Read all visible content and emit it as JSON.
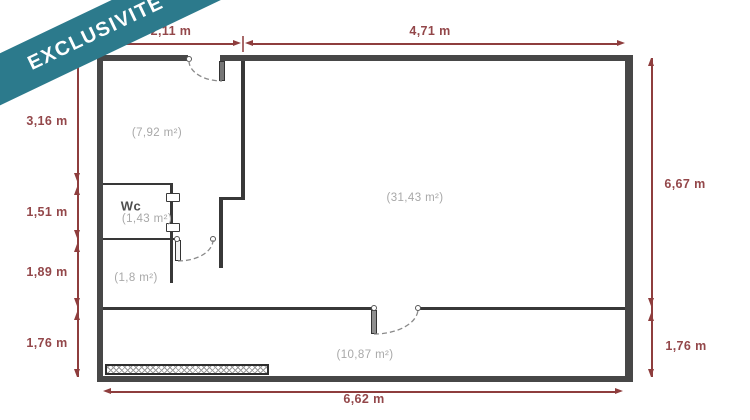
{
  "banner": {
    "label": "EXCLUSIVITÉ"
  },
  "colors": {
    "banner_teal": "#2c7a8c",
    "dimension_red": "#8e3d3d",
    "wall_gray": "#474747",
    "room_label_gray": "#a8a8a8"
  },
  "dimensions": {
    "top": [
      {
        "label": "2,11 m"
      },
      {
        "label": "4,71 m"
      }
    ],
    "left": [
      {
        "label": "3,16 m"
      },
      {
        "label": "1,51 m"
      },
      {
        "label": "1,89 m"
      },
      {
        "label": "1,76 m"
      }
    ],
    "right": [
      {
        "label": "6,67 m"
      },
      {
        "label": "1,76 m"
      }
    ],
    "bottom": [
      {
        "label": "6,62 m"
      }
    ]
  },
  "rooms": {
    "room_7_92": {
      "area": "(7,92 m²)"
    },
    "wc": {
      "name": "Wc",
      "area": "(1,43 m²)"
    },
    "room_1_8": {
      "area": "(1,8 m²)"
    },
    "room_31_43": {
      "area": "(31,43 m²)"
    },
    "room_10_87": {
      "area": "(10,87 m²)"
    }
  }
}
